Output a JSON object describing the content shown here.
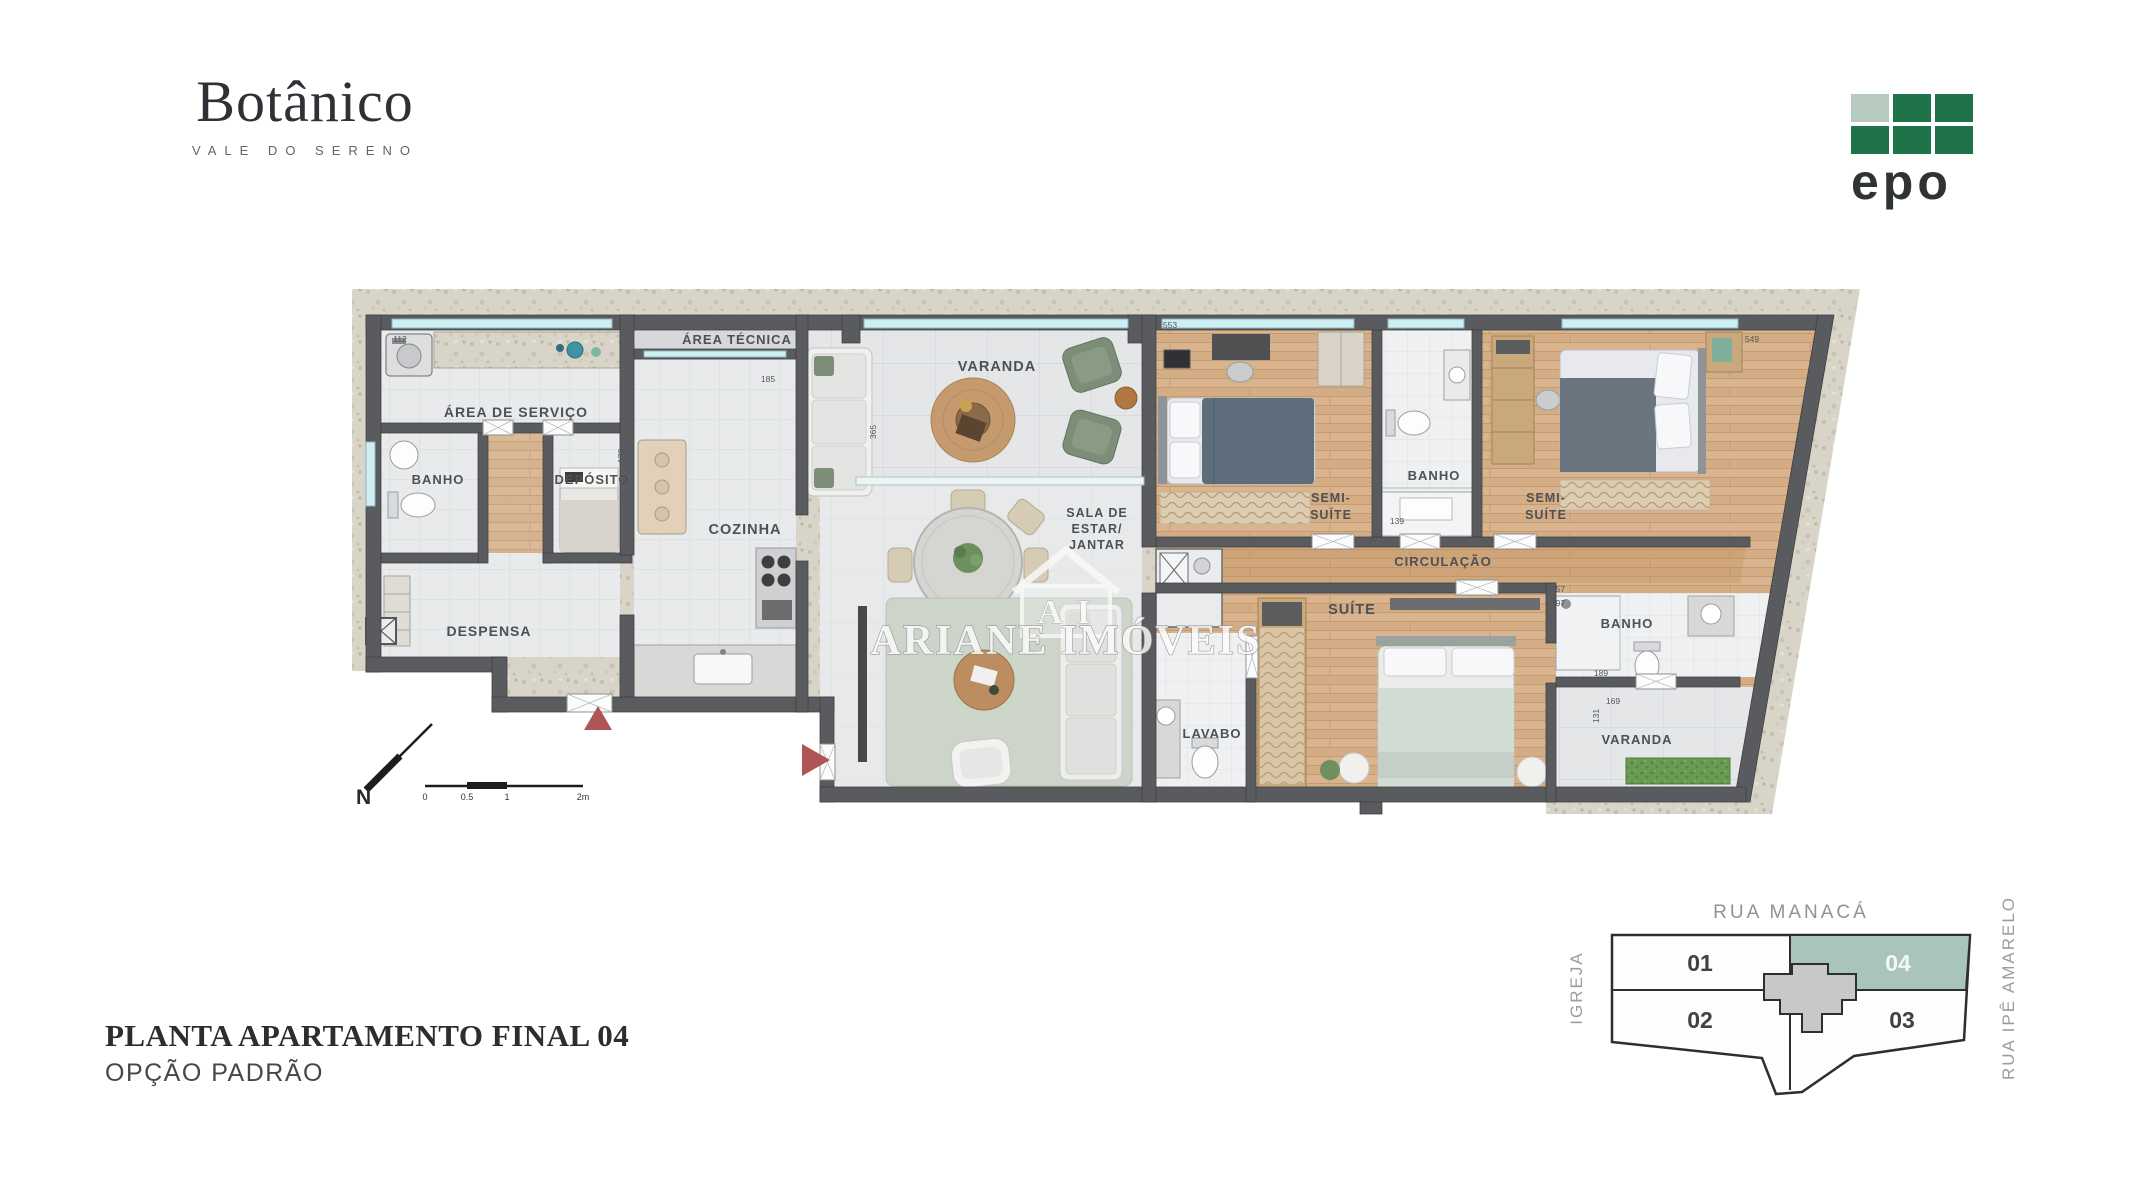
{
  "brand": {
    "name": "Botânico",
    "tagline": "VALE DO SERENO"
  },
  "developer": {
    "name": "epo"
  },
  "title": {
    "line1": "PLANTA APARTAMENTO FINAL 04",
    "line2": "OPÇÃO PADRÃO"
  },
  "watermark": {
    "initials": "A I",
    "name": "ARIANE IMÓVEIS"
  },
  "rooms": {
    "area_servico": "ÁREA DE SERVIÇO",
    "banho_servico": "BANHO",
    "deposito": "DEPÓSITO",
    "despensa": "DESPENSA",
    "area_tecnica": "ÁREA TÉCNICA",
    "cozinha": "COZINHA",
    "varanda": "VARANDA",
    "sala_l1": "SALA DE",
    "sala_l2": "ESTAR/",
    "sala_l3": "JANTAR",
    "semi_suite_l1": "SEMI-",
    "semi_suite_l2": "SUÍTE",
    "banho_semi": "BANHO",
    "circulacao": "CIRCULAÇÃO",
    "suite": "SUÍTE",
    "lavabo": "LAVABO",
    "banho_suite": "BANHO",
    "varanda_suite": "VARANDA"
  },
  "dims": [
    "112",
    "553",
    "185",
    "365",
    "357",
    "397",
    "139",
    "178",
    "549",
    "189",
    "169",
    "131"
  ],
  "compass": {
    "north": "N"
  },
  "scale_bar": {
    "t0": "0",
    "t1": "0.5",
    "t2": "1",
    "t3": "2m"
  },
  "keyplan": {
    "street_top": "RUA MANACÁ",
    "street_left": "IGREJA",
    "street_right": "RUA IPÊ AMARELO",
    "units": [
      {
        "id": "01"
      },
      {
        "id": "02"
      },
      {
        "id": "03"
      },
      {
        "id": "04"
      }
    ],
    "highlighted_unit": "04"
  },
  "colors": {
    "wall": "#595b5e",
    "stone_band": "#d8d4c8",
    "wood_floor": "#d9b48e",
    "window_glass": "#cdeef3",
    "keyplan_highlight": "#a9c5b9",
    "epo_green": "#1e7448",
    "epo_light_square": "#b7cabe",
    "entry_arrow": "#b05555",
    "bed_dark": "#5d6d7c",
    "suite_bed": "#d2dcd5",
    "green_armchair": "#7c8d78",
    "grass": "#6a9b54",
    "label_text": "#4e5154"
  }
}
